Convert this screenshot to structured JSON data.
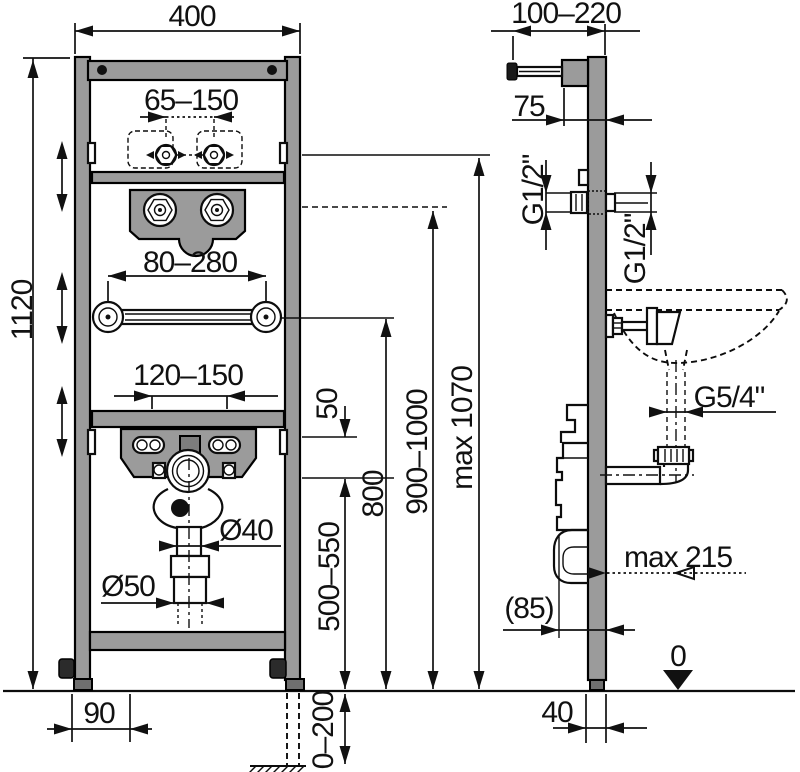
{
  "diagram": {
    "title": "Washbasin installation frame — dimensioned technical drawing",
    "front_view": {
      "frame_width": "400",
      "water_conn_spacing": "65–150",
      "frame_height": "1120",
      "stud_spacing": "80–280",
      "bolt_slot_spacing": "120–150",
      "gap_50": "50",
      "drain_pipe_dia": "Ø40",
      "outlet_pipe_dia": "Ø50",
      "drain_height": "500–550",
      "stud_height": "800",
      "rim_height": "900–1000",
      "tap_conn_height": "max 1070",
      "foot_width": "90",
      "leg_adjust": "0–200"
    },
    "side_view": {
      "wall_bracket_range": "100–220",
      "bracket_offset": "75",
      "water_conn_front": "G1/2\"",
      "water_conn_rear": "G1/2\"",
      "drain_conn": "G5/4\"",
      "drain_reach": "max 215",
      "trap_offset": "(85)",
      "floor_level": "0",
      "profile_depth": "40"
    }
  }
}
